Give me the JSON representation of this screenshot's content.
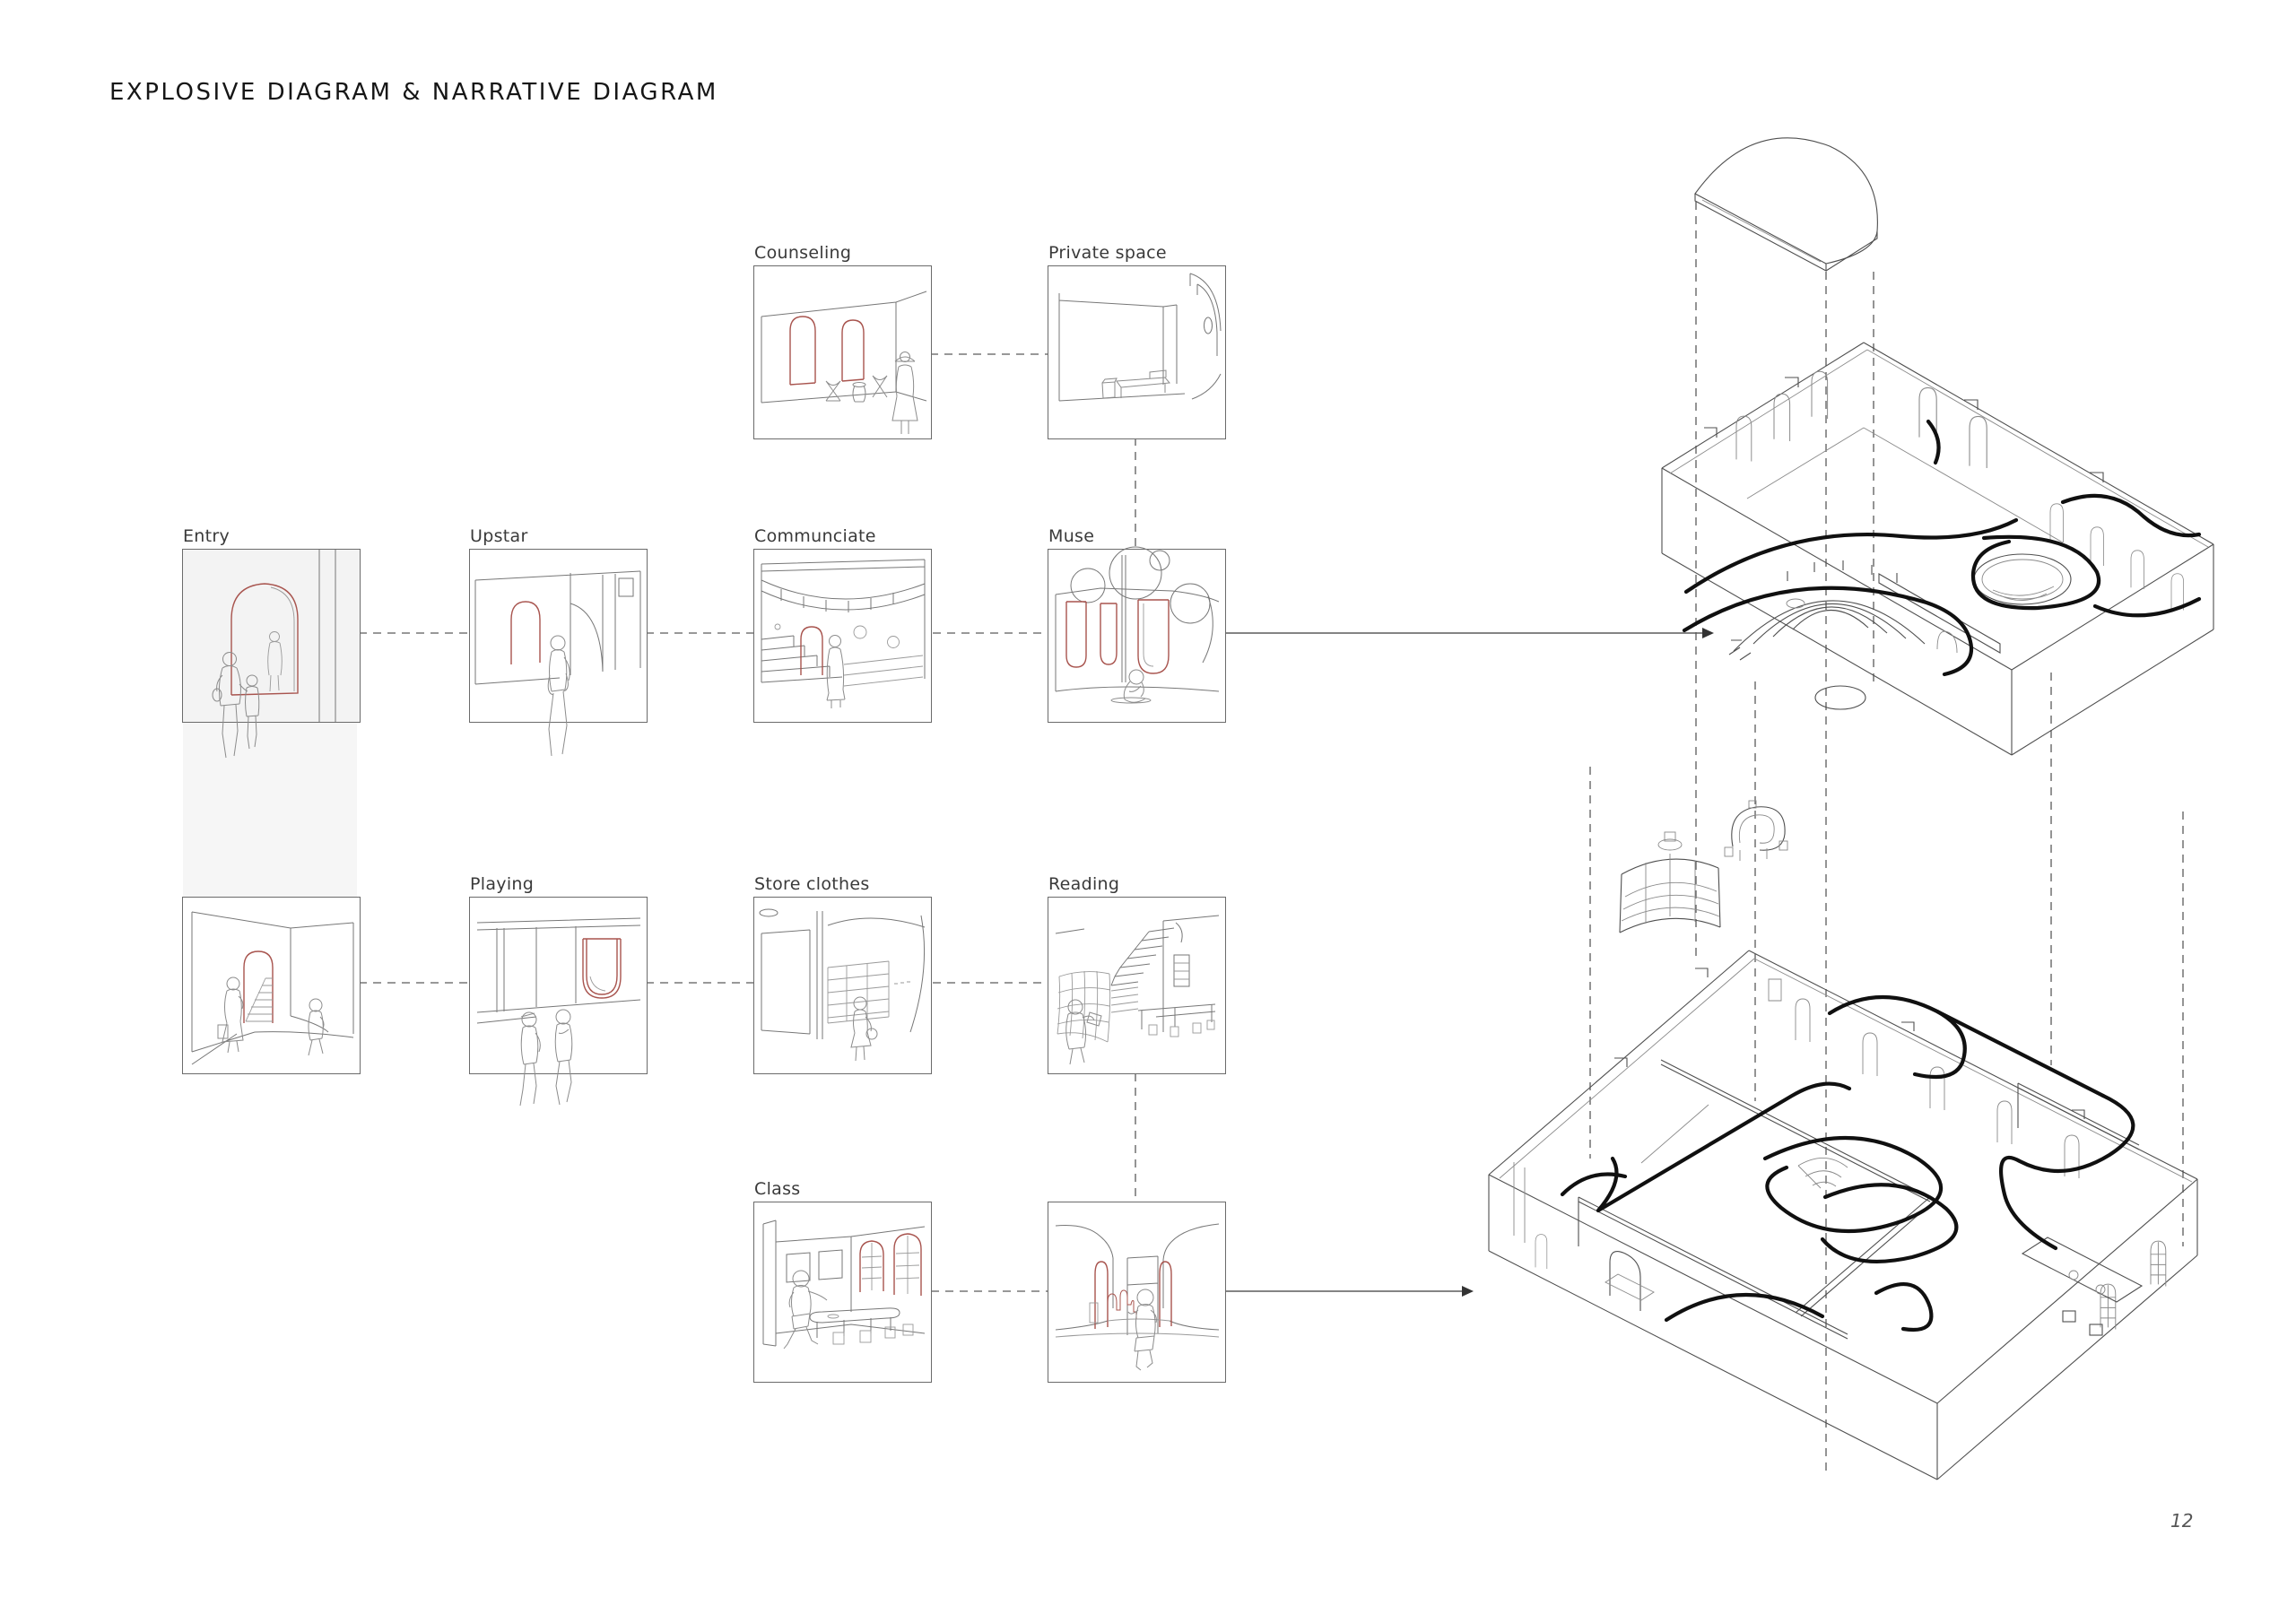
{
  "page": {
    "title": "EXPLOSIVE DIAGRAM & NARRATIVE DIAGRAM",
    "page_number": "12"
  },
  "colors": {
    "accent_red": "#a8544e",
    "flow_black": "#101010",
    "line_dark": "#4f4f4f",
    "line_mid": "#777777",
    "line_light": "#9a9a9a",
    "dash_grey": "#5a5a5a",
    "entry_fill": "#f3f3f3",
    "text_dark": "#161616"
  },
  "panels": [
    {
      "id": "counseling",
      "label": "Counseling"
    },
    {
      "id": "private-space",
      "label": "Private space"
    },
    {
      "id": "entry",
      "label": "Entry"
    },
    {
      "id": "upstar",
      "label": "Upstar"
    },
    {
      "id": "communciate",
      "label": "Communciate"
    },
    {
      "id": "muse",
      "label": "Muse"
    },
    {
      "id": "entry-stairs",
      "label": ""
    },
    {
      "id": "playing",
      "label": "Playing"
    },
    {
      "id": "store-clothes",
      "label": "Store clothes"
    },
    {
      "id": "reading",
      "label": "Reading"
    },
    {
      "id": "class",
      "label": "Class"
    },
    {
      "id": "corridor",
      "label": ""
    }
  ],
  "axonometrics": [
    {
      "id": "upper-floor-axon"
    },
    {
      "id": "ground-floor-axon"
    }
  ]
}
